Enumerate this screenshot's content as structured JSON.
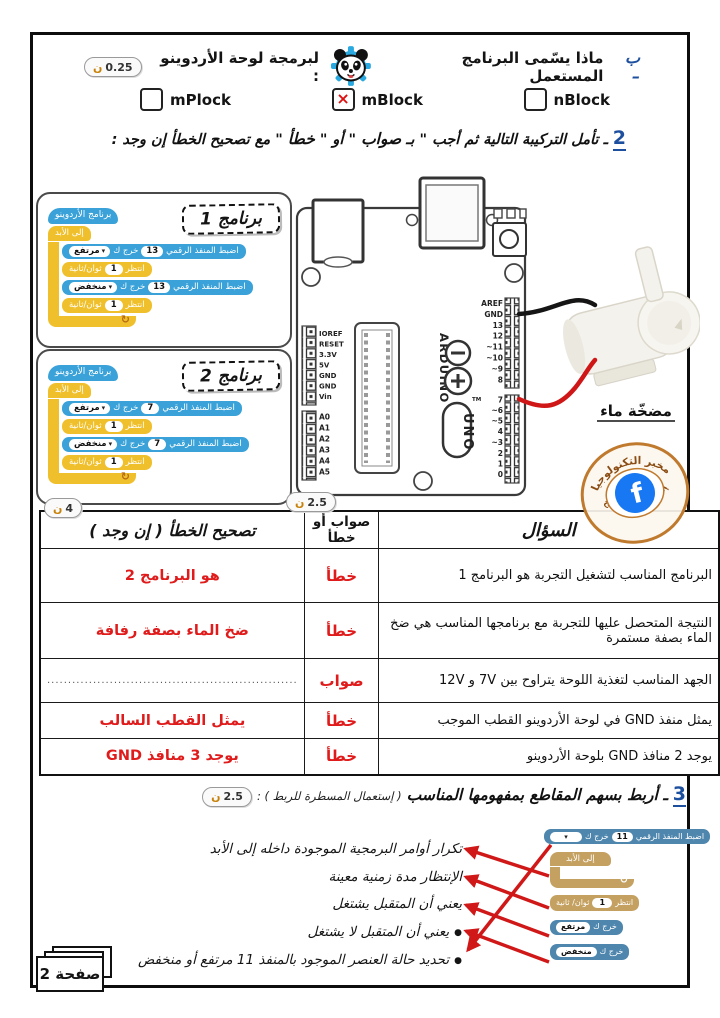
{
  "icons": {
    "check": "×",
    "caret": "▾",
    "loop": "↻",
    "bullet": "●",
    "facebook_f": "f"
  },
  "scores": {
    "qb": {
      "num": "0.25",
      "unit": "ن"
    },
    "table_correction": {
      "num": "4",
      "unit": "ن"
    },
    "table_answer": {
      "num": "2.5",
      "unit": "ن"
    },
    "q3": {
      "num": "2.5",
      "unit": "ن"
    }
  },
  "question_b": {
    "prefix": "ب –",
    "before_logo": "ماذا يسّمى البرنامج المستعمل",
    "after_logo": "لبرمجة لوحة الأردوينو :",
    "options": [
      {
        "label": "mPlock",
        "checked": false
      },
      {
        "label": "mBlock",
        "checked": true
      },
      {
        "label": "nBlock",
        "checked": false
      }
    ]
  },
  "question_2": {
    "number": "2",
    "t1": "ـ تأمل التركيبة التالية ثم أجب \" بـ",
    "b1": "صواب",
    "t2": "\" أو \"",
    "b2": "خطأ",
    "t3": "\" مع تصحيح الخطأ إن وجد :"
  },
  "programs": {
    "p1": {
      "title": "برنامج 1",
      "hat": "برنامج الأردوينو",
      "forever": "إلى الأبد",
      "set_label": "اضبط المنفذ الرقمي",
      "out_label": "خرج ك",
      "pin": "13",
      "high": "مرتفع",
      "low": "منخفض",
      "wait_label": "انتظر",
      "wait_num": "1",
      "wait_unit": "ثوان/ثانية"
    },
    "p2": {
      "title": "برنامج 2",
      "hat": "برنامج الأردوينو",
      "forever": "إلى الأبد",
      "set_label": "اضبط المنفذ الرقمي",
      "out_label": "خرج ك",
      "pin": "7",
      "high": "مرتفع",
      "low": "منخفض",
      "wait_label": "انتظر",
      "wait_num": "1",
      "wait_unit": "ثوان/ثانية"
    }
  },
  "arduino": {
    "brand": "ARDUINO",
    "model": "UNO",
    "tm": "TM",
    "power_pins": [
      "IOREF",
      "RESET",
      "3.3V",
      "5V",
      "GND",
      "GND",
      "Vin"
    ],
    "analog_pins": [
      "A0",
      "A1",
      "A2",
      "A3",
      "A4",
      "A5"
    ],
    "digital_top": [
      "AREF",
      "GND",
      "13",
      "12",
      "~11",
      "~10",
      "~9",
      "8"
    ],
    "digital_bottom": [
      "7",
      "~6",
      "~5",
      "4",
      "~3",
      "2",
      "1",
      "0"
    ]
  },
  "pump_label": "مضخّة ماء",
  "stamp": {
    "top": "مخبر التكنولوجيا",
    "bottom": "إعدادية أولاد صالح"
  },
  "table": {
    "headers": {
      "question": "السؤال",
      "answer": "صواب أو خطأ",
      "correction": "تصحيح الخطأ ( إن وجد )"
    },
    "rows": [
      {
        "question": "البرنامج المناسب لتشغيل التجربة هو البرنامج 1",
        "answer": "خطأ",
        "correction": "هو البرنامج 2"
      },
      {
        "question": "النتيجة المتحصل عليها للتجربة مع برنامجها المناسب هي ضخ الماء بصفة مستمرة",
        "answer": "خطأ",
        "correction": "ضخ الماء بصفة رفافة"
      },
      {
        "question": "الجهد المناسب لتغذية اللوحة يتراوح بين 7V و 12V",
        "answer": "صواب",
        "correction": "............................................................"
      },
      {
        "question": "يمثل منفذ GND في لوحة الأردوينو القطب الموجب",
        "answer": "خطأ",
        "correction": "يمثل القطب السالب"
      },
      {
        "question": "يوجد 2 منافذ GND بلوحة الأردوينو",
        "answer": "خطأ",
        "correction": "يوجد 3 منافذ GND"
      }
    ]
  },
  "question_3": {
    "number": "3",
    "text": "ـ أربط بسهم المقاطع بمفهومها المناسب",
    "hint": "( إستعمال المسطرة للربط ) :",
    "items": [
      "تكرار أوامر البرمجية الموجودة داخله إلى الأبد",
      "الإنتظار مدة زمنية معينة",
      "يعني أن المتقبل يشتغل",
      "يعني أن المتقبل لا يشتغل",
      "تحديد حالة العنصر الموجود بالمنفذ 11 مرتفع أو منخفض"
    ],
    "blocks": {
      "set_label": "اضبط المنفذ الرقمي",
      "pin": "11",
      "out_label": "خرج ك",
      "forever": "إلى الأبد",
      "wait_label": "انتظر",
      "wait_num": "1",
      "wait_unit": "ثوان/ ثانية",
      "high": "مرتفع",
      "low": "منخفض"
    }
  },
  "page_label": "صفحة 2"
}
